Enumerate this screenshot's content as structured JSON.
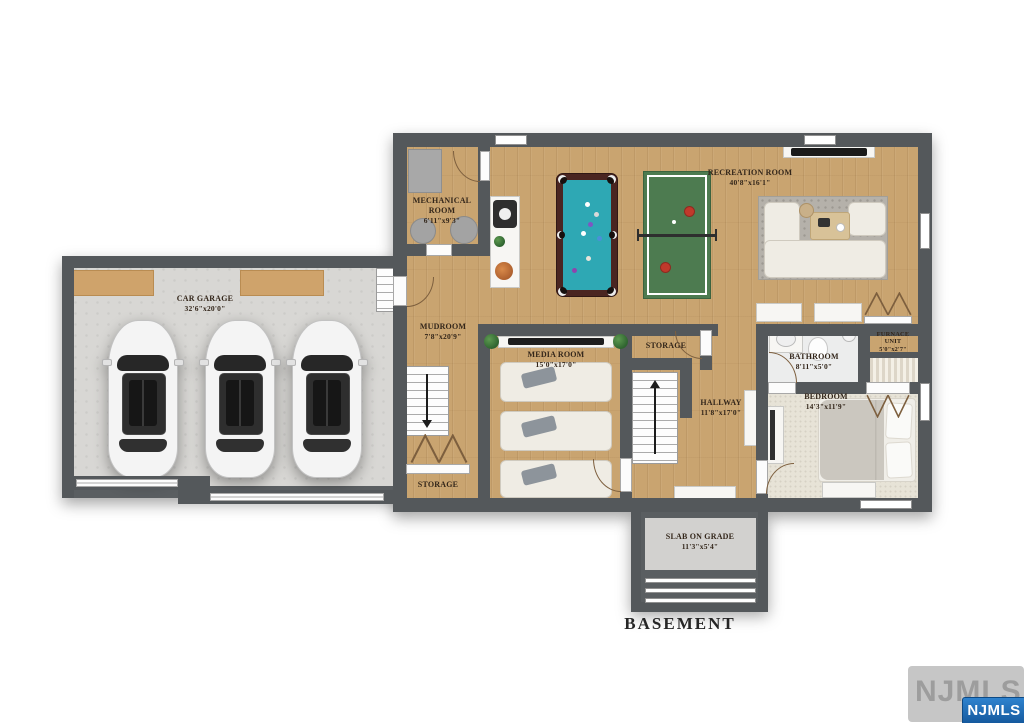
{
  "floor_title": "BASEMENT",
  "rooms": {
    "car_garage": {
      "name": "CAR GARAGE",
      "dims": "32'6\"x20'0\""
    },
    "mechanical": {
      "name": "MECHANICAL ROOM",
      "dims": "6'11\"x9'3\""
    },
    "recreation": {
      "name": "RECREATION ROOM",
      "dims": "40'8\"x16'1\""
    },
    "mudroom": {
      "name": "MUDROOM",
      "dims": "7'8\"x20'9\""
    },
    "media": {
      "name": "MEDIA ROOM",
      "dims": "15'0\"x17'0\""
    },
    "storage_center": {
      "name": "STORAGE"
    },
    "storage_mudroom": {
      "name": "STORAGE"
    },
    "hallway": {
      "name": "HALLWAY",
      "dims": "11'8\"x17'0\""
    },
    "bathroom": {
      "name": "BATHROOM",
      "dims": "8'11\"x5'0\""
    },
    "furnace": {
      "name": "FURNACE UNIT",
      "dims": "5'0\"x2'7\""
    },
    "bedroom": {
      "name": "BEDROOM",
      "dims": "14'3\"x11'9\""
    },
    "slab": {
      "name": "SLAB ON GRADE",
      "dims": "11'3\"x5'4\""
    }
  },
  "watermark": {
    "back": "NJMLS",
    "front": "NJMLS"
  },
  "colors": {
    "wall": "#54585b",
    "wood": "#c9a470",
    "concrete": "#d8d7d4",
    "carpet": "#e7e3d7",
    "pool_felt": "#2ea8b4",
    "pingpong_green": "#4d7b50",
    "watermark_blue": "#1e6fc0"
  }
}
